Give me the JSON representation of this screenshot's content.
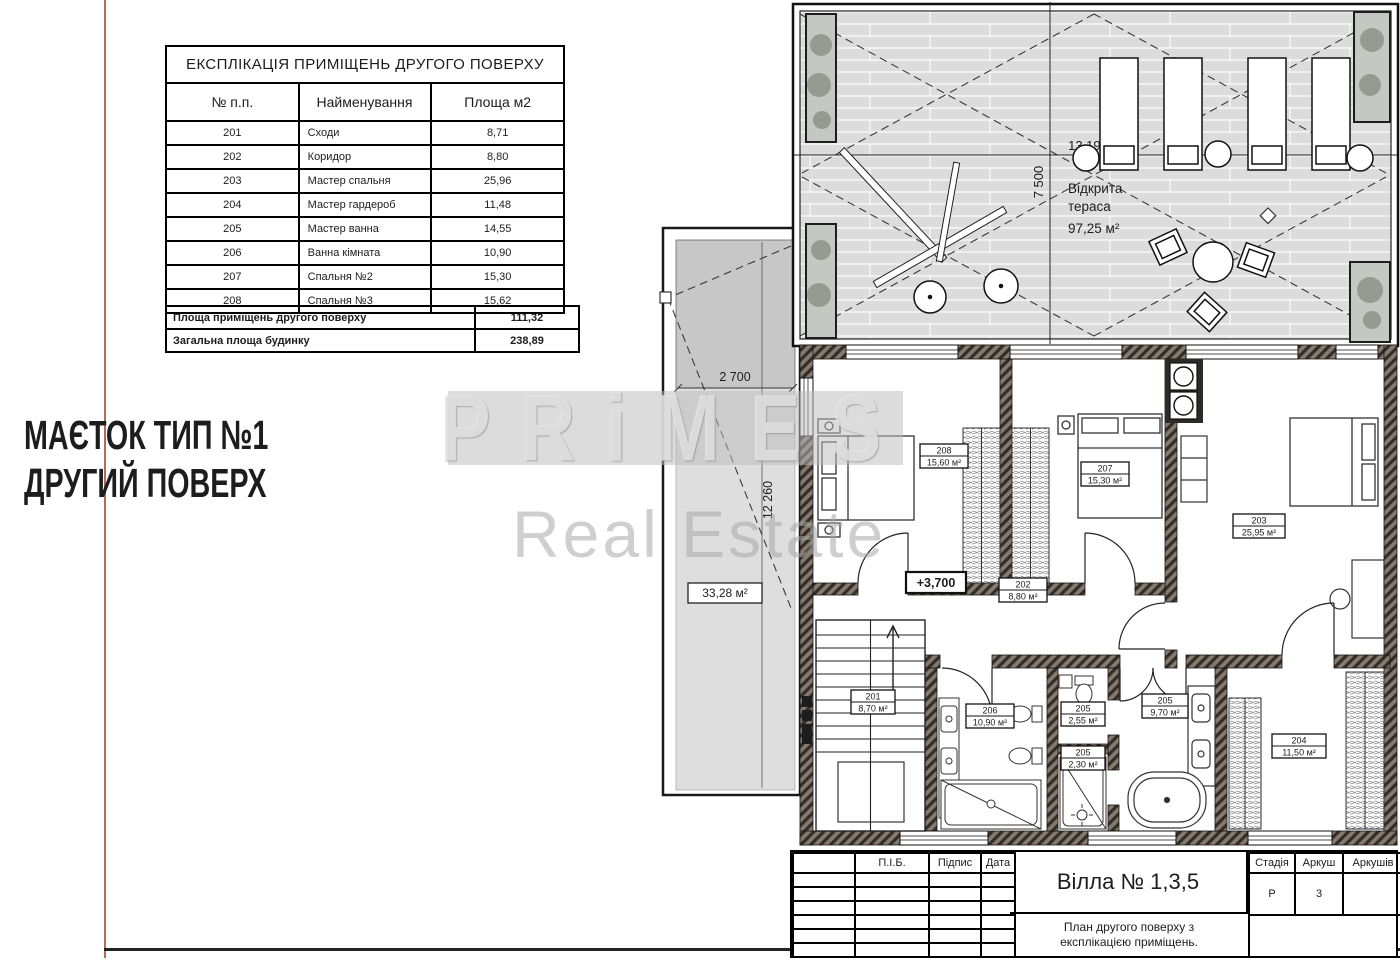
{
  "colors": {
    "frame_line": "#b96a57",
    "bottom_rule": "#232323",
    "wall_hatch_dark": "#332d27",
    "wall_hatch_light": "#857a6f",
    "deck_gray": "#dcdcdc",
    "roof_gray_dark": "#c7c7c7",
    "roof_gray_light": "#dedede"
  },
  "project_title": {
    "line1": "МАЄТОК ТИП №1",
    "line2": "ДРУГИЙ ПОВЕРХ"
  },
  "watermark": {
    "brand": "PRiMES",
    "sub": "Real Estate"
  },
  "explication_table": {
    "title": "ЕКСПЛІКАЦІЯ ПРИМІЩЕНЬ ДРУГОГО ПОВЕРХУ",
    "columns": [
      "№ п.п.",
      "Найменування",
      "Площа м2"
    ],
    "rows": [
      [
        "201",
        "Сходи",
        "8,71"
      ],
      [
        "202",
        "Коридор",
        "8,80"
      ],
      [
        "203",
        "Мастер спальня",
        "25,96"
      ],
      [
        "204",
        "Мастер гардероб",
        "11,48"
      ],
      [
        "205",
        "Мастер ванна",
        "14,55"
      ],
      [
        "206",
        "Ванна кімната",
        "10,90"
      ],
      [
        "207",
        "Спальня №2",
        "15,30"
      ],
      [
        "208",
        "Спальня №3",
        "15,62"
      ]
    ],
    "summary": [
      {
        "label": "Площа приміщень другого поверху",
        "value": "111,32"
      },
      {
        "label": "Загальна площа будинку",
        "value": "238,89"
      }
    ]
  },
  "terrace": {
    "label_line1": "Відкрита",
    "label_line2": "тераса",
    "area": "97,25 м²",
    "dim_w": "13 190",
    "dim_h": "7 500"
  },
  "roof": {
    "dim_w": "2 700",
    "dim_h": "12 260",
    "area": "33,28 м²"
  },
  "plan": {
    "level": "+3,700",
    "rooms": {
      "r208": {
        "num": "208",
        "area": "15,60 м²"
      },
      "r207": {
        "num": "207",
        "area": "15,30 м²"
      },
      "r203": {
        "num": "203",
        "area": "25,95 м²"
      },
      "r202": {
        "num": "202",
        "area": "8,80 м²"
      },
      "r201": {
        "num": "201",
        "area": "8,70 м²"
      },
      "r206": {
        "num": "206",
        "area": "10,90 м²"
      },
      "r205a": {
        "num": "205",
        "area": "9,70 м²"
      },
      "r205b": {
        "num": "205",
        "area": "2,55 м²"
      },
      "r205c": {
        "num": "205",
        "area": "2,30 м²"
      },
      "r204": {
        "num": "204",
        "area": "11,50 м²"
      }
    }
  },
  "title_block": {
    "person_columns": [
      "П.І.Б.",
      "Підпис",
      "Дата"
    ],
    "doc_title": "Вілла № 1,3,5",
    "doc_subtitle_line1": "План другого поверху з",
    "doc_subtitle_line2": "експлікацією приміщень.",
    "stage_label": "Стадія",
    "stage_value": "Р",
    "sheet_label": "Аркуш",
    "sheet_value": "3",
    "sheets_label": "Аркушів",
    "sheets_value": ""
  }
}
